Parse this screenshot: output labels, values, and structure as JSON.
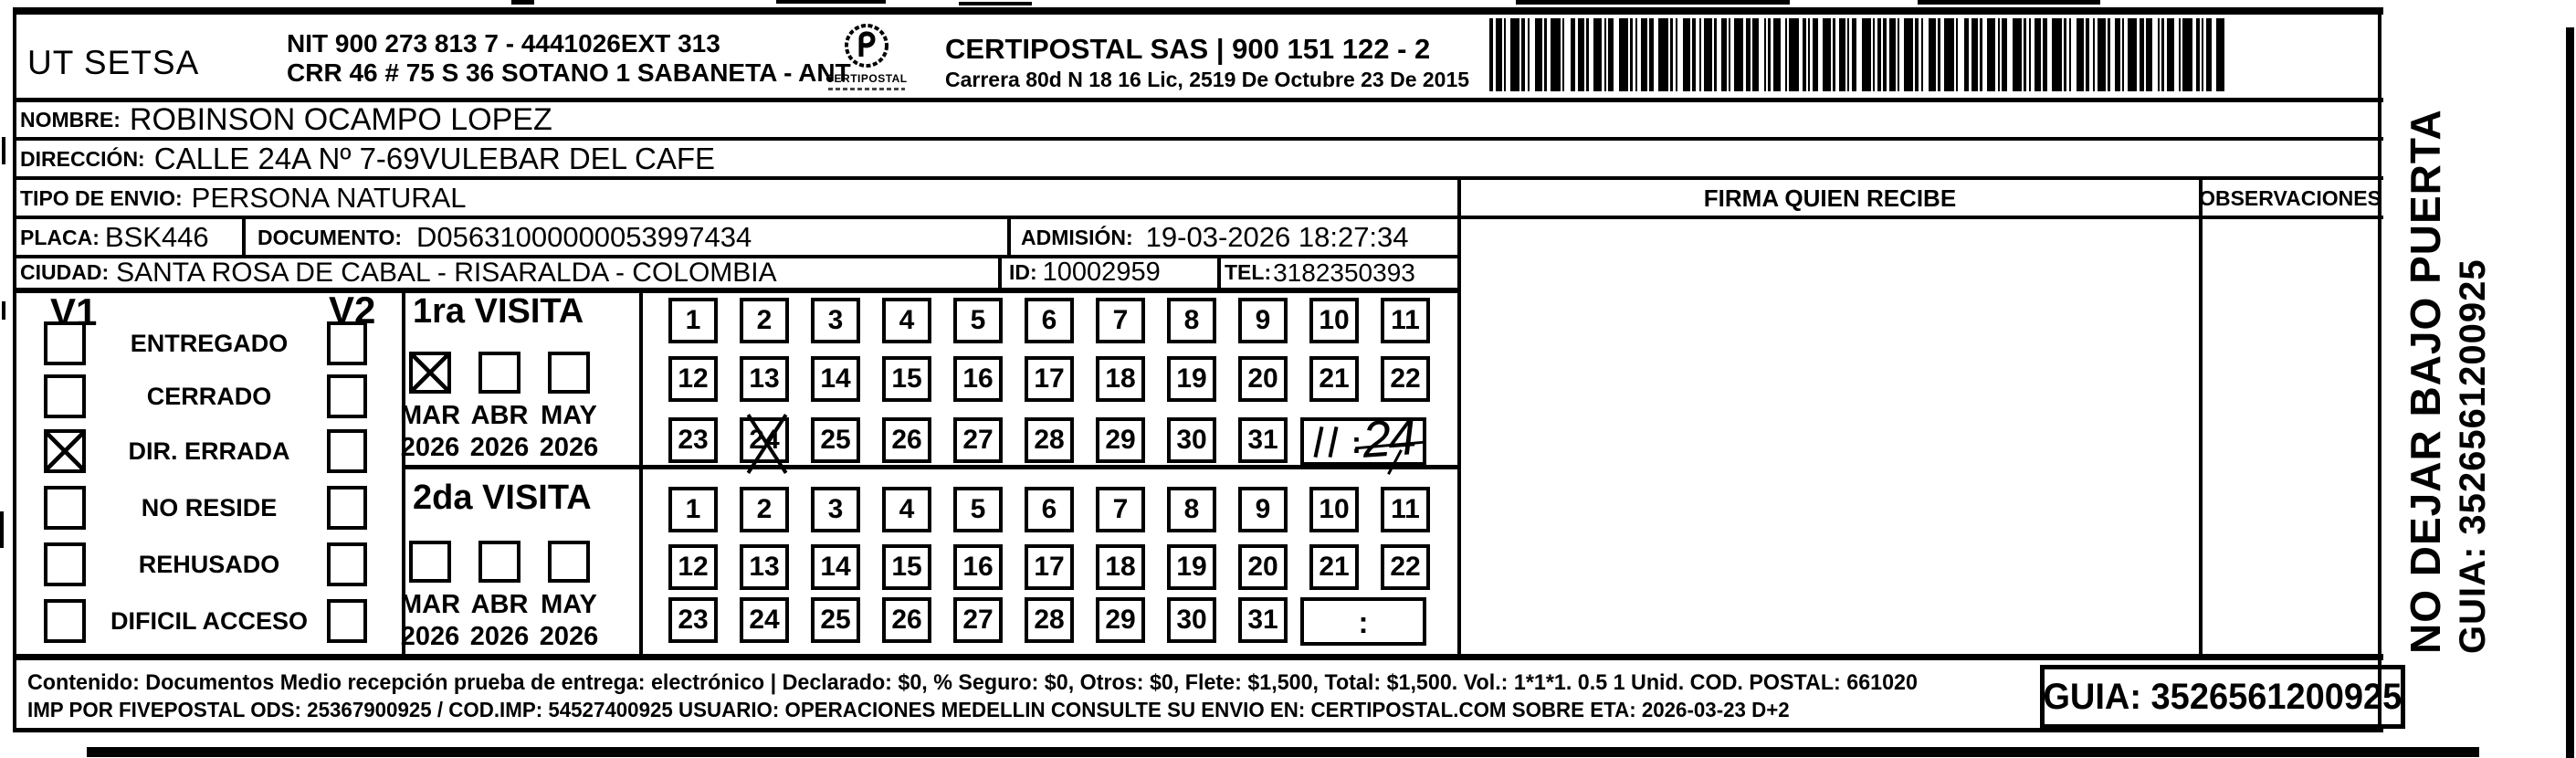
{
  "header": {
    "company": "UT SETSA",
    "nit_line1": "NIT 900 273 813 7 - 4441026EXT 313",
    "nit_line2": "CRR 46 # 75 S 36 SOTANO 1 SABANETA - ANT",
    "logo_text": "CERTIPOSTAL",
    "certipostal_line1": "CERTIPOSTAL SAS | 900 151 122 - 2",
    "certipostal_line2": "Carrera 80d N 18 16  Lic, 2519 De Octubre 23 De 2015"
  },
  "fields": {
    "nombre_label": "NOMBRE:",
    "nombre": "ROBINSON OCAMPO LOPEZ",
    "direccion_label": "DIRECCIÓN:",
    "direccion": "CALLE 24A Nº 7-69VULEBAR DEL CAFE",
    "tipo_label": "TIPO DE ENVIO:",
    "tipo": "PERSONA NATURAL",
    "placa_label": "PLACA:",
    "placa": "BSK446",
    "documento_label": "DOCUMENTO:",
    "documento": "D05631000000053997434",
    "admision_label": "ADMISIÓN:",
    "admision": "19-03-2026 18:27:34",
    "ciudad_label": "CIUDAD:",
    "ciudad": "SANTA ROSA DE CABAL - RISARALDA - COLOMBIA",
    "id_label": "ID:",
    "id": "10002959",
    "tel_label": "TEL:",
    "tel": "3182350393"
  },
  "signature": {
    "header": "FIRMA QUIEN RECIBE"
  },
  "observations": {
    "header": "OBSERVACIONES"
  },
  "visits": {
    "v1_header": "V1",
    "v2_header": "V2",
    "statuses": [
      {
        "label": "ENTREGADO",
        "v1_checked": false,
        "v2_checked": false
      },
      {
        "label": "CERRADO",
        "v1_checked": false,
        "v2_checked": false
      },
      {
        "label": "DIR. ERRADA",
        "v1_checked": true,
        "v2_checked": false
      },
      {
        "label": "NO RESIDE",
        "v1_checked": false,
        "v2_checked": false
      },
      {
        "label": "REHUSADO",
        "v1_checked": false,
        "v2_checked": false
      },
      {
        "label": "DIFICIL ACCESO",
        "v1_checked": false,
        "v2_checked": false
      }
    ],
    "days": [
      1,
      2,
      3,
      4,
      5,
      6,
      7,
      8,
      9,
      10,
      11,
      12,
      13,
      14,
      15,
      16,
      17,
      18,
      19,
      20,
      21,
      22,
      23,
      24,
      25,
      26,
      27,
      28,
      29,
      30,
      31
    ],
    "time_colon": ":",
    "visit1": {
      "title": "1ra VISITA",
      "months": [
        {
          "month": "MAR",
          "year": "2026",
          "checked": true
        },
        {
          "month": "ABR",
          "year": "2026",
          "checked": false
        },
        {
          "month": "MAY",
          "year": "2026",
          "checked": false
        }
      ],
      "crossed_day": 24,
      "time": "11:24"
    },
    "visit2": {
      "title": "2da VISITA",
      "months": [
        {
          "month": "MAR",
          "year": "2026",
          "checked": false
        },
        {
          "month": "ABR",
          "year": "2026",
          "checked": false
        },
        {
          "month": "MAY",
          "year": "2026",
          "checked": false
        }
      ],
      "crossed_day": null,
      "time": ""
    }
  },
  "side_note": {
    "line1": "NO DEJAR BAJO PUERTA",
    "line2": "GUIA: 3526561200925"
  },
  "footer": {
    "line1": "Contenido: Documentos Medio recepción prueba de entrega: electrónico | Declarado: $0, % Seguro: $0, Otros: $0, Flete: $1,500, Total: $1,500. Vol.: 1*1*1. 0.5  1 Unid. COD. POSTAL: 661020",
    "line2": "IMP POR FIVEPOSTAL ODS: 25367900925 / COD.IMP: 54527400925 USUARIO: OPERACIONES MEDELLIN CONSULTE SU ENVIO EN: CERTIPOSTAL.COM SOBRE ETA: 2026-03-23 D+2",
    "guia": "GUIA: 3526561200925"
  }
}
